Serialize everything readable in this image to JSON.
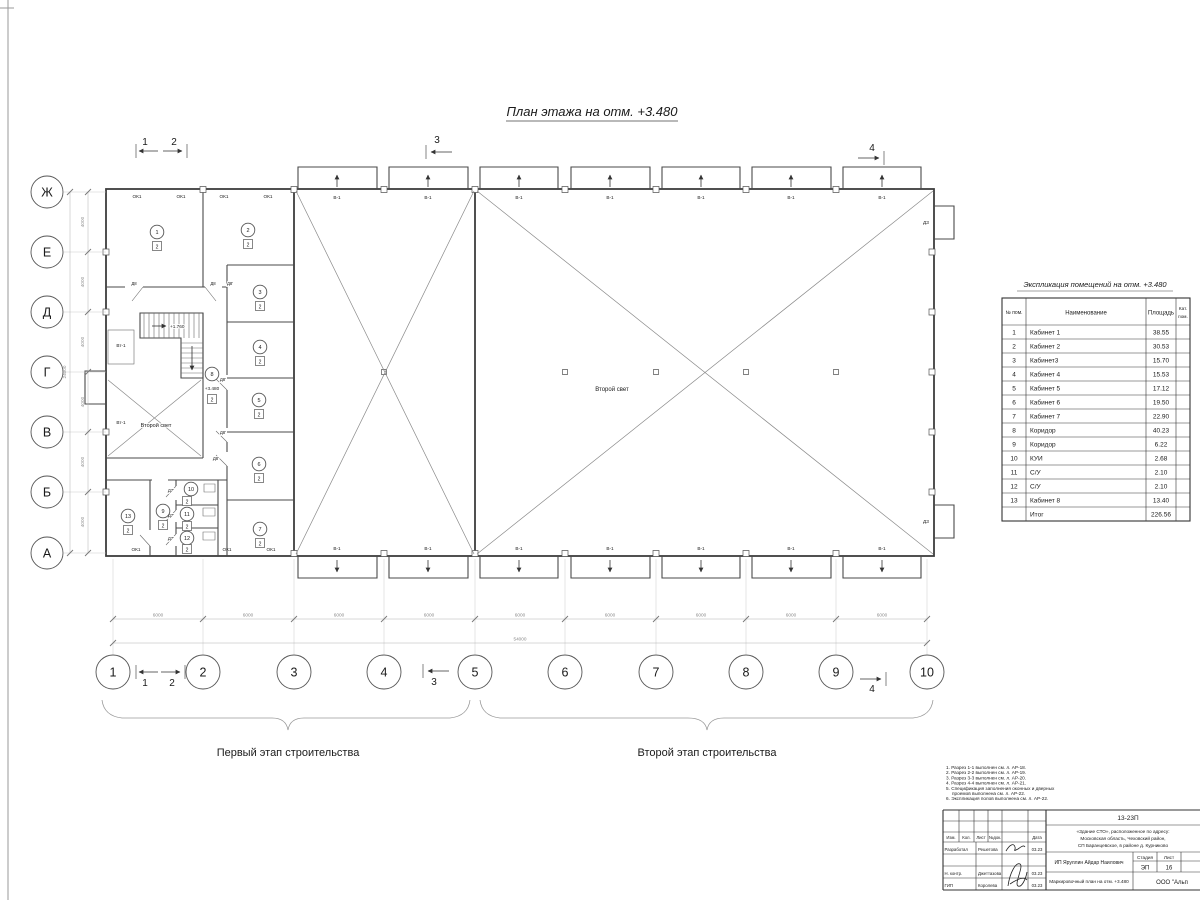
{
  "page": {
    "title": "План этажа на отм. +3.480",
    "stage1": "Первый этап строительства",
    "stage2": "Второй этап строительства"
  },
  "plan": {
    "axis_rows": [
      "Ж",
      "Е",
      "Д",
      "Г",
      "В",
      "Б",
      "А"
    ],
    "axis_cols": [
      "1",
      "2",
      "3",
      "4",
      "5",
      "6",
      "7",
      "8",
      "9",
      "10"
    ],
    "dims": {
      "bay": "6000",
      "total_w": "54000",
      "row": "4000",
      "total_h": "24000"
    },
    "sections": [
      "1",
      "2",
      "3",
      "4"
    ],
    "labels": {
      "ok1": "ОК1",
      "v1": "В-1",
      "vt1": "Вт-1",
      "d8": "Д8",
      "d8p": "Д8'",
      "d7p": "Д7'",
      "d3": "ДЗ",
      "second_light": "Второй свет",
      "stair_elev": "+1.760",
      "floor_elev": "+3.480"
    },
    "room_cat": "2",
    "room_numbers": [
      "1",
      "2",
      "3",
      "4",
      "5",
      "6",
      "7",
      "8",
      "9",
      "10",
      "11",
      "12",
      "13"
    ]
  },
  "schedule": {
    "title": "Экспликация помещений на отм. +3.480",
    "headers": {
      "num": "№ пом.",
      "name": "Наименование",
      "area": "Площадь",
      "cat1": "Кат.",
      "cat2": "пом."
    },
    "rows": [
      {
        "num": "1",
        "name": "Кабинет 1",
        "area": "38.55"
      },
      {
        "num": "2",
        "name": "Кабинет 2",
        "area": "30.53"
      },
      {
        "num": "3",
        "name": "Кабинет3",
        "area": "15.70"
      },
      {
        "num": "4",
        "name": "Кабинет 4",
        "area": "15.53"
      },
      {
        "num": "5",
        "name": "Кабинет 5",
        "area": "17.12"
      },
      {
        "num": "6",
        "name": "Кабинет 6",
        "area": "19.50"
      },
      {
        "num": "7",
        "name": "Кабинет 7",
        "area": "22.90"
      },
      {
        "num": "8",
        "name": "Коридор",
        "area": "40.23"
      },
      {
        "num": "9",
        "name": "Коридор",
        "area": "6.22"
      },
      {
        "num": "10",
        "name": "КУИ",
        "area": "2.68"
      },
      {
        "num": "11",
        "name": "С/У",
        "area": "2.10"
      },
      {
        "num": "12",
        "name": "С/У",
        "area": "2.10"
      },
      {
        "num": "13",
        "name": "Кабинет 8",
        "area": "13.40"
      },
      {
        "num": "",
        "name": "Итог",
        "area": "226.56"
      }
    ]
  },
  "notes": {
    "lines": [
      "1. Разрез 1-1 выполнен см. л. АР-18.",
      "2. Разрез 2-2 выполнен см. л. АР-19.",
      "3. Разрез 3-3 выполнен см. л. АР-20.",
      "4. Разрез 4-4 выполнен см. л. АР-21.",
      "5. Спецификация заполнения оконных и дверных",
      "проемов выполнена см. л. АР-22.",
      "6. Экспликация полов выполнена см. л. АР-22."
    ]
  },
  "titleblock": {
    "code": "13-23П",
    "address1": "«Здание СТО», расположенное по адресу:",
    "address2": "Московская область, Чеховский район,",
    "address3": "СП Баранцевское, в районе д. Курниково",
    "cols": {
      "izm": "Изм.",
      "kol": "Кол.",
      "list": "Лист",
      "ndok": "№док.",
      "podl": "Подл.",
      "data": "Дата"
    },
    "rows": [
      {
        "role": "Разработал",
        "name": "Решетова",
        "date": "03.23"
      },
      {
        "role": "Н. контр.",
        "name": "Джеттазова",
        "date": "03.23"
      },
      {
        "role": "ГИП",
        "name": "Королева",
        "date": "03.23"
      }
    ],
    "client": "ИП Яруллин Айдар Наилович",
    "stage_label": "Стадия",
    "sheet_label": "Лист",
    "stage": "ЭП",
    "sheet": "16",
    "doc_title": "Маркировочный план на отм. +3.480",
    "company": "ООО \"Альп"
  }
}
